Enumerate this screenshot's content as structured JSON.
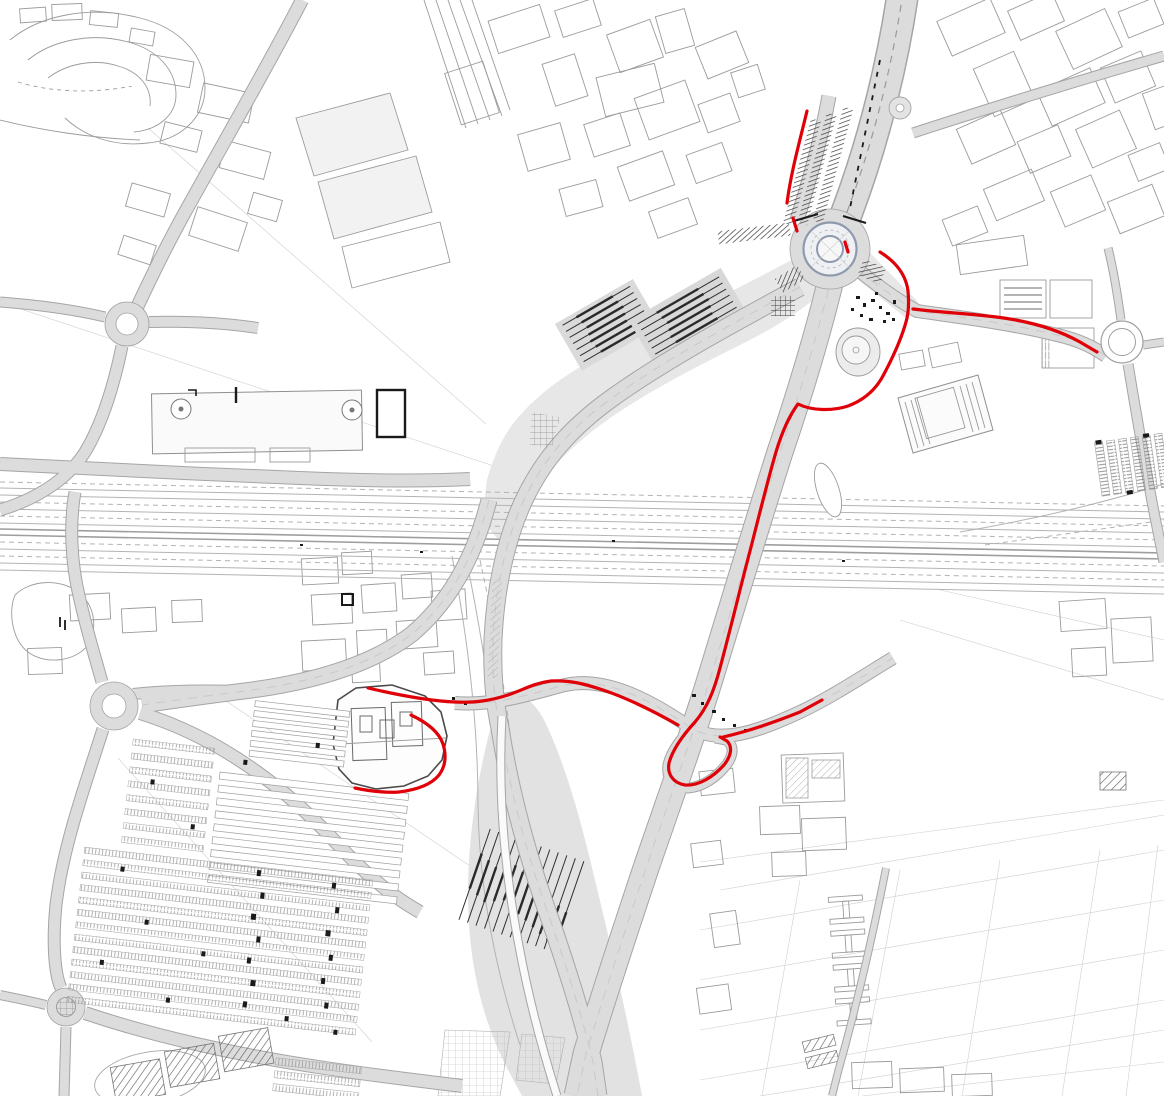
{
  "document": {
    "kind": "engineering-site-plan",
    "description": "CAD-style urban plan of a road and railway interchange with red highlighted routes, five roundabouts, an east-west railway corridor, railway yards, a station building and a large park-and-ride parking lot"
  },
  "canvas": {
    "viewBox": "0 0 1164 1096",
    "width": 1164,
    "height": 1096,
    "background": "#ffffff"
  },
  "palette": {
    "paper": "#ffffff",
    "road_fill": "#dcdcdc",
    "road_casing": "#a5a5a5",
    "area_fill": "#e7e7e7",
    "building_outline": "#9b9b9b",
    "rail_line": "#b3b3b3",
    "dark_marks": "#1a1a1a",
    "roundabout_ring": "#8e99ad",
    "highlight_route": "#e00008"
  },
  "features": {
    "roundabouts": [
      {
        "name": "main-roundabout",
        "cx": 830,
        "cy": 249
      },
      {
        "name": "west-roundabout",
        "cx": 127,
        "cy": 324
      },
      {
        "name": "southwest-roundabout",
        "cx": 114,
        "cy": 706
      },
      {
        "name": "bottom-left-roundabout",
        "cx": 66,
        "cy": 1007
      },
      {
        "name": "east-roundabout",
        "cx": 1122,
        "cy": 342
      }
    ],
    "highlight_routes": [
      {
        "name": "route-north-approach"
      },
      {
        "name": "route-main-north-south-with-loop"
      },
      {
        "name": "route-east-spur"
      },
      {
        "name": "route-cross-link-west"
      },
      {
        "name": "route-station-building-ring"
      }
    ],
    "railway": {
      "name": "railway-corridor",
      "orientation": "east-west",
      "yards": 3
    },
    "parking": {
      "name": "park-and-ride-lot",
      "sections": 4
    },
    "station": {
      "name": "station-building"
    }
  }
}
